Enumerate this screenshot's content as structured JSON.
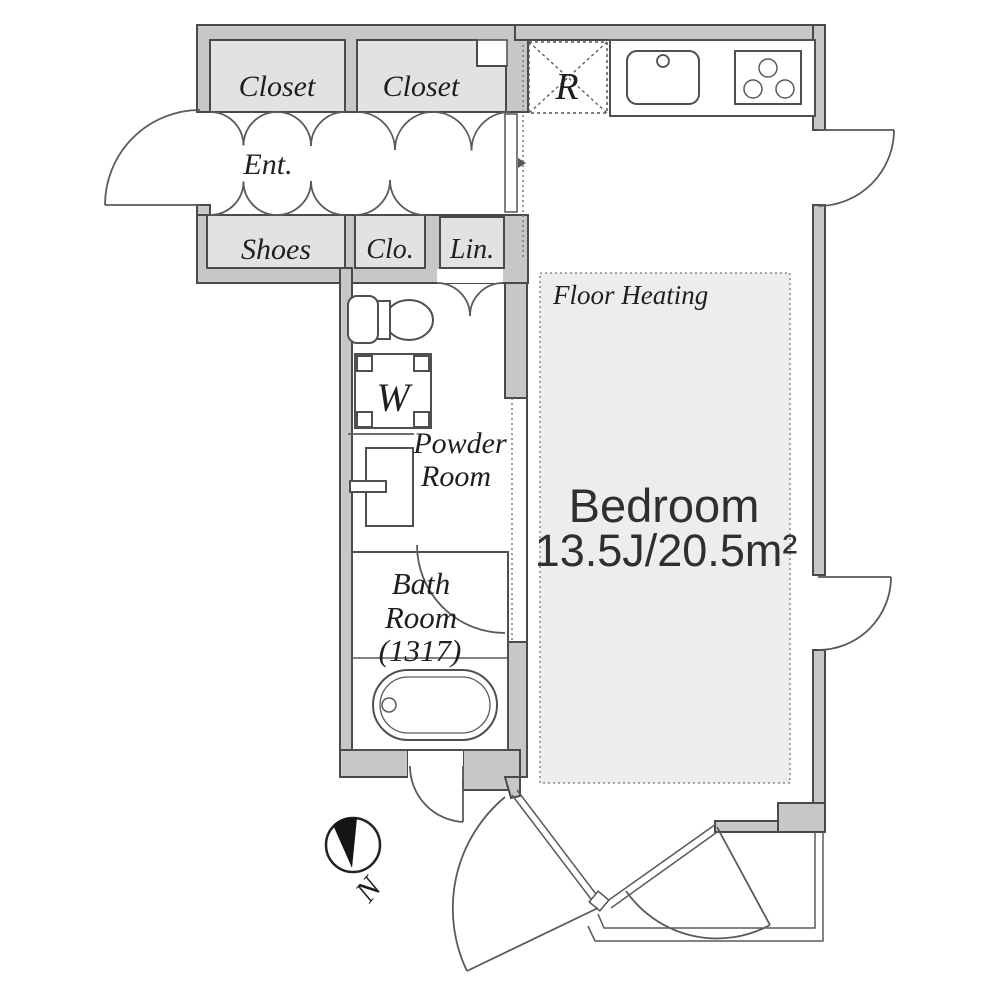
{
  "plan": {
    "labels": {
      "closet_left": "Closet",
      "closet_right": "Closet",
      "entrance": "Ent.",
      "shoes": "Shoes",
      "clo": "Clo.",
      "lin": "Lin.",
      "refrigerator": "R",
      "washer": "W",
      "floor_heating": "Floor Heating",
      "powder_room_line1": "Powder",
      "powder_room_line2": "Room",
      "bath_line1": "Bath",
      "bath_line2": "Room",
      "bath_line3": "(1317)",
      "bedroom_name": "Bedroom",
      "bedroom_size": "13.5J/20.5m²",
      "compass_north": "N"
    },
    "colors": {
      "wall": "#c7c7c7",
      "storage": "#e2e2e2",
      "floor_heating_fill": "#ededed",
      "outline": "#4a4a4a",
      "text": "#1f1f1f"
    }
  }
}
